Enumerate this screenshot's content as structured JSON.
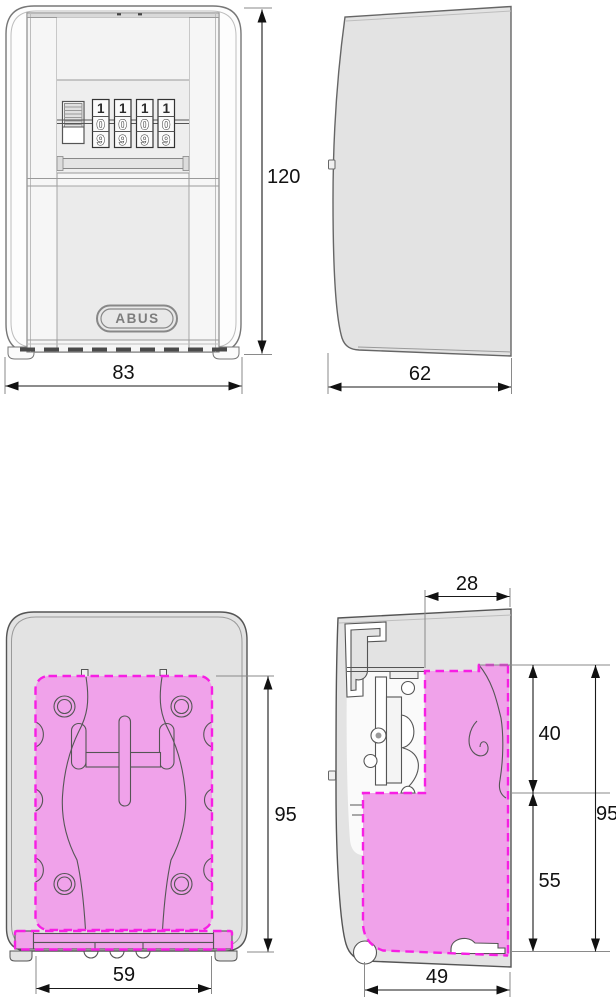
{
  "logo_text": "ABUS",
  "views": {
    "front": {
      "dials": [
        [
          "1",
          "0",
          "9"
        ],
        [
          "1",
          "0",
          "9"
        ],
        [
          "1",
          "0",
          "9"
        ],
        [
          "1",
          "0",
          "9"
        ]
      ],
      "dims": {
        "height": "120",
        "width": "83"
      }
    },
    "side": {
      "dims": {
        "depth": "62"
      }
    },
    "back": {
      "dims": {
        "plate_height": "95",
        "plate_width": "59"
      }
    },
    "section": {
      "dims": {
        "depth_top": "28",
        "inner_upper": "40",
        "inner_lower": "55",
        "inner_height": "95",
        "inner_width": "49"
      }
    }
  },
  "colors": {
    "highlight_fill": "#f0a2ea",
    "highlight_border": "#f71fe4",
    "housing_gray": "#e3e3e3",
    "door_gray": "#ebebeb",
    "dim_line": "#1a1a1a"
  }
}
